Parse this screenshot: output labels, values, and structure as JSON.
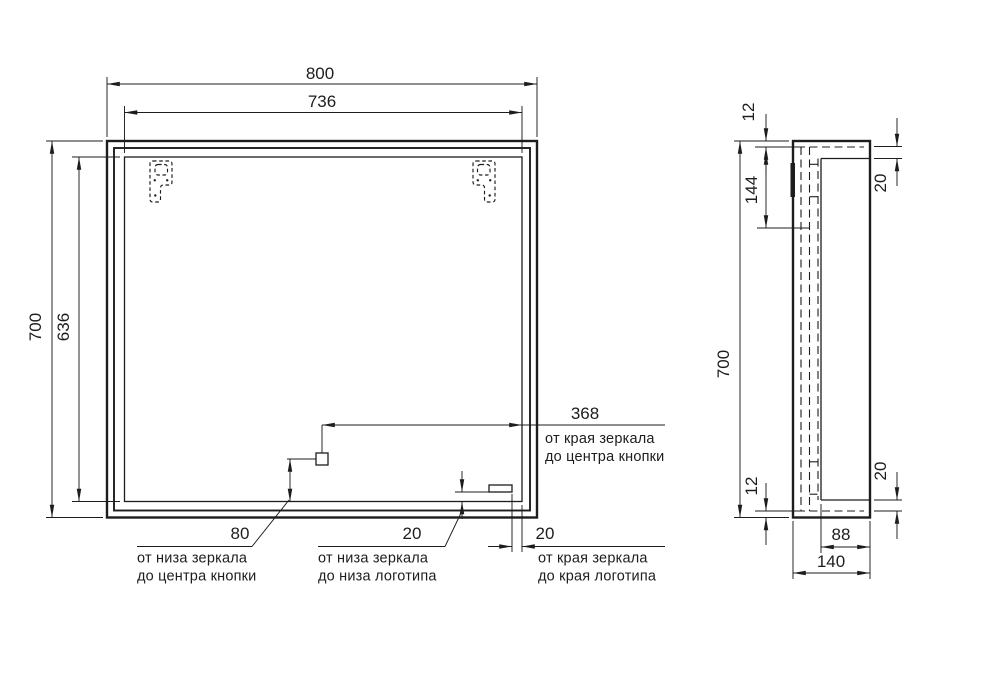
{
  "drawing": {
    "front_view": {
      "dims": {
        "width_outer": "800",
        "width_inner": "736",
        "height_outer": "700",
        "height_inner": "636",
        "edge_to_button": "368",
        "bottom_to_button": "80",
        "bottom_to_logo": "20",
        "edge_to_logo": "20"
      },
      "notes": {
        "edge_to_button": {
          "line1": "от края зеркала",
          "line2": "до центра кнопки"
        },
        "bottom_to_button": {
          "line1": "от низа зеркала",
          "line2": "до центра кнопки"
        },
        "bottom_to_logo": {
          "line1": "от низа зеркала",
          "line2": "до низа логотипа"
        },
        "edge_to_logo": {
          "line1": "от края зеркала",
          "line2": "до края логотипа"
        }
      }
    },
    "side_view": {
      "dims": {
        "height": "700",
        "top_gap": "12",
        "bracket_span": "144",
        "top_inset": "20",
        "bottom_gap": "12",
        "bottom_inset": "20",
        "inner_depth": "88",
        "outer_depth": "140"
      }
    },
    "colors": {
      "ink": "#1d1d1d",
      "paper": "#ffffff"
    }
  }
}
